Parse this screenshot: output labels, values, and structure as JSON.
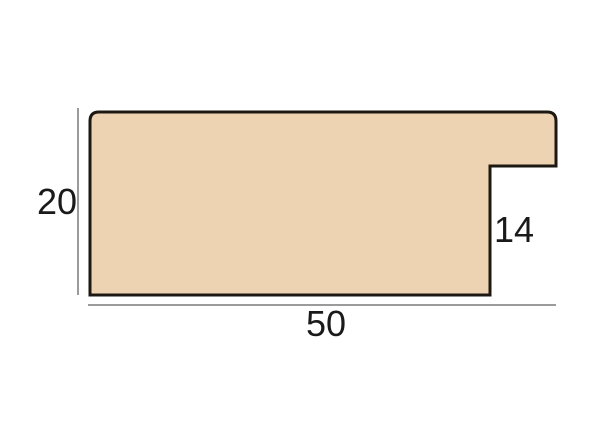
{
  "diagram": {
    "labels": {
      "height": "20",
      "width": "50",
      "rebate": "14"
    },
    "colors": {
      "profile_fill": "#EDD3B1",
      "profile_outline": "#1E1813",
      "dimension_line": "#9B9B9B",
      "label_text": "#1A1A1A",
      "background": "#FFFFFF"
    }
  }
}
